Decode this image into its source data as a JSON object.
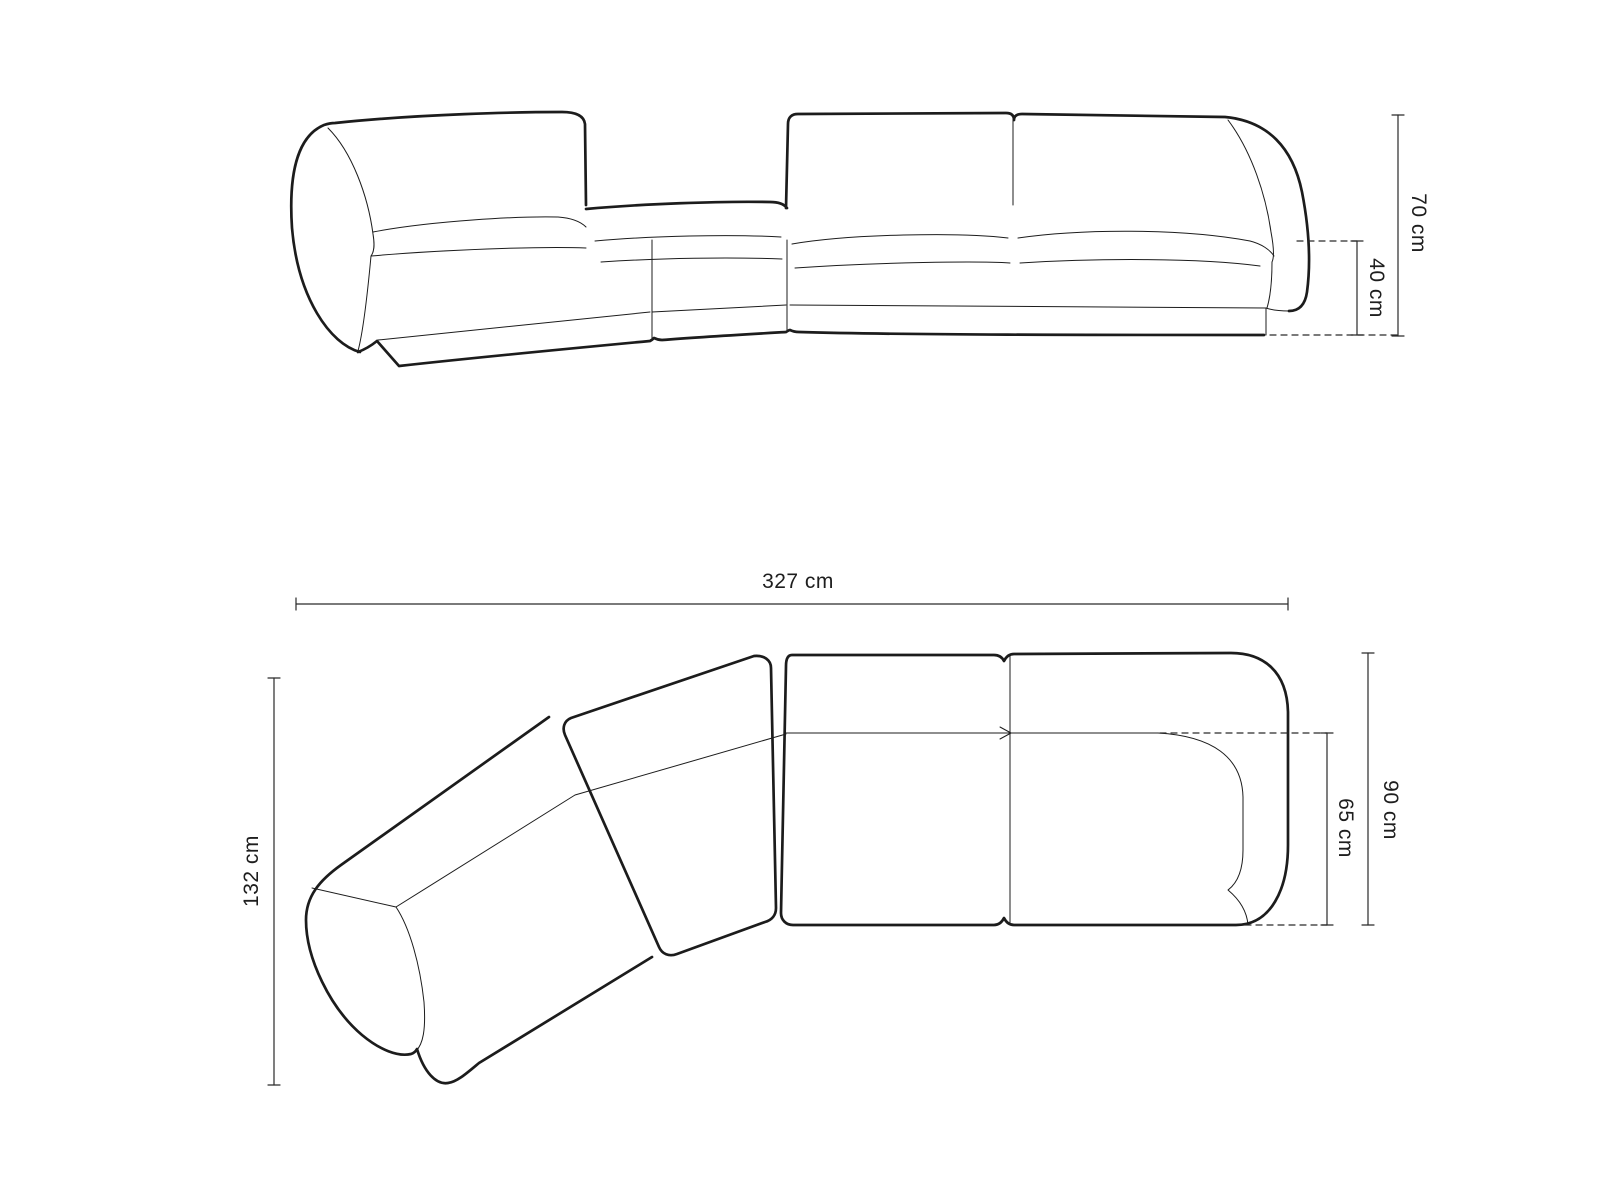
{
  "page": {
    "background": "#ffffff",
    "line_color": "#1c1c1c",
    "description": "Technical dimension drawing of a modular corner sofa, front elevation above and top plan view below"
  },
  "views": {
    "front": {
      "title": "front-elevation-view",
      "dimensions": {
        "total_height": {
          "label": "70 cm"
        },
        "seat_height": {
          "label": "40 cm"
        }
      }
    },
    "top": {
      "title": "top-plan-view",
      "dimensions": {
        "total_width": {
          "label": "327 cm"
        },
        "total_depth": {
          "label": "132 cm"
        },
        "module_depth": {
          "label": "90 cm"
        },
        "seat_depth": {
          "label": "65 cm"
        }
      }
    }
  }
}
